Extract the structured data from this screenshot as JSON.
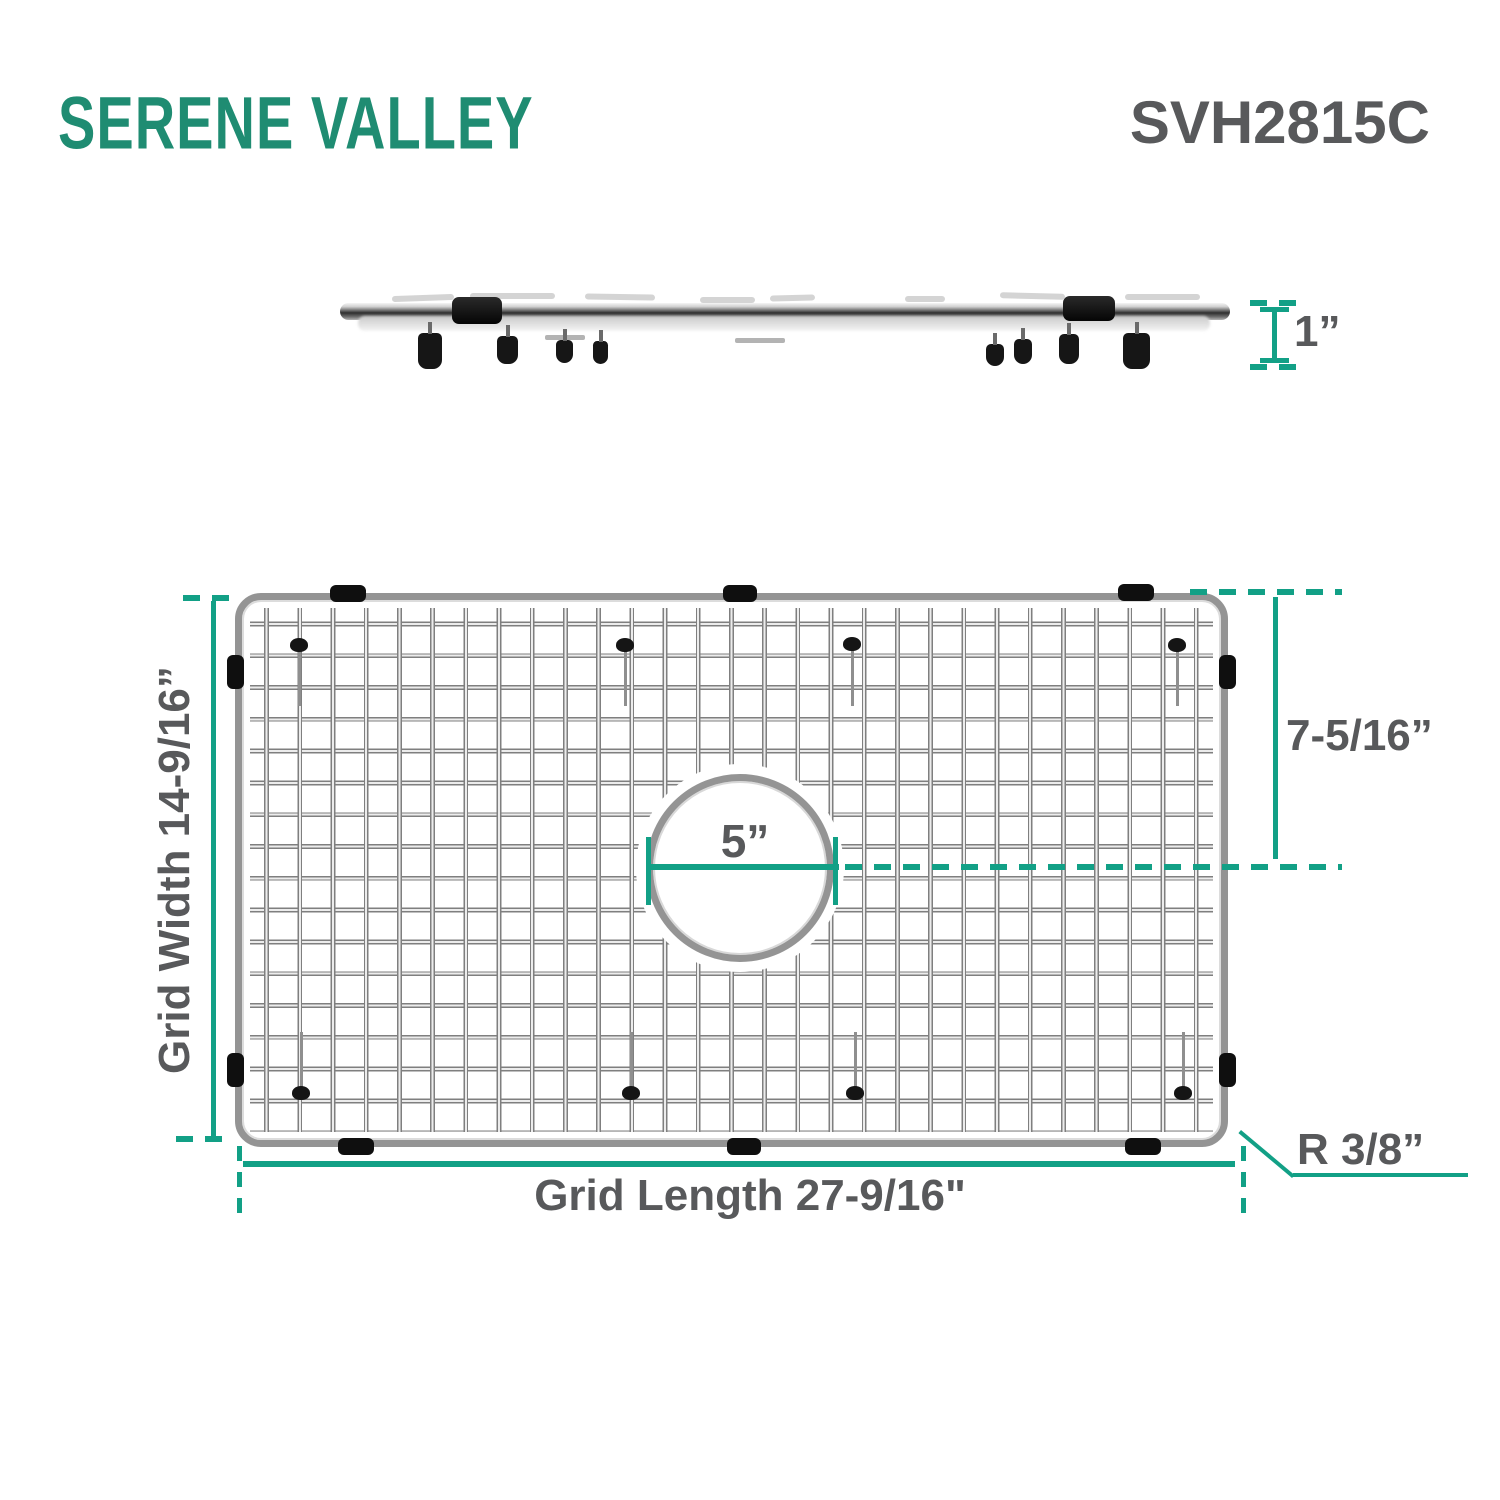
{
  "header": {
    "logo": "SERENE VALLEY",
    "model": "SVH2815C"
  },
  "colors": {
    "dimension_teal": "#12a086",
    "logo_green": "#1f8c72",
    "label_gray": "#58595b"
  },
  "side_view": {
    "height_label": "1”"
  },
  "grid_view": {
    "width_label": "Grid Width 14-9/16”",
    "length_label": "Grid Length 27-9/16\"",
    "hole_diameter_label": "5”",
    "hole_center_offset_label": "7-5/16”",
    "corner_radius_label": "R 3/8”"
  }
}
